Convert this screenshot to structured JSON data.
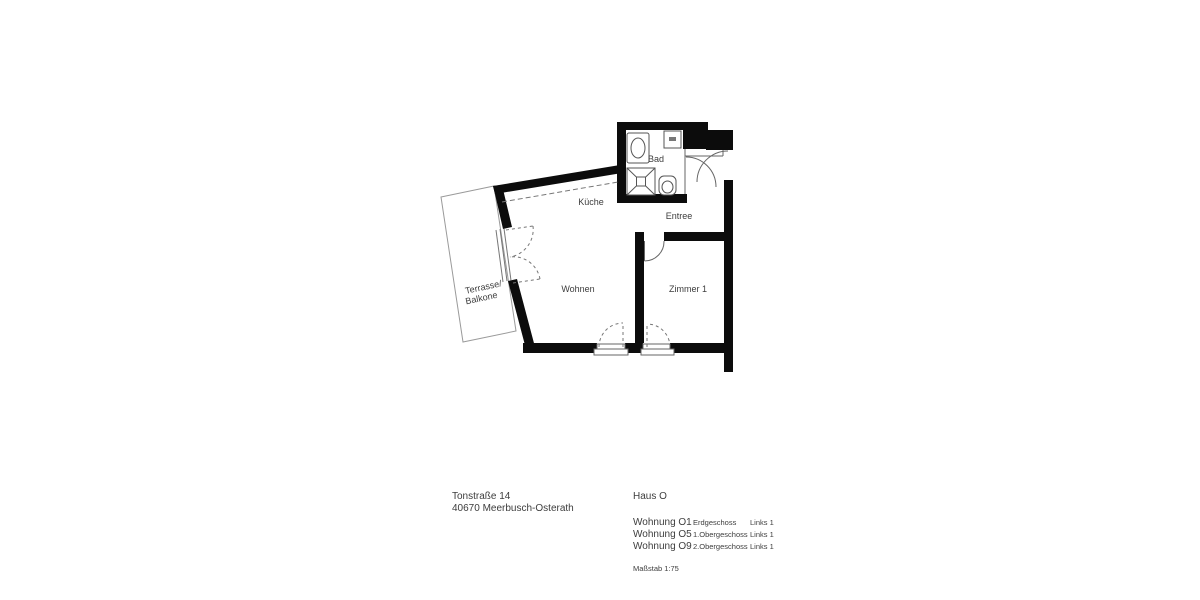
{
  "colors": {
    "wall": "#0c0c0c",
    "text": "#3d3d3d",
    "thin_line": "#666666",
    "light_line": "#9a9a9a"
  },
  "plan": {
    "rooms": {
      "bad": "Bad",
      "kueche": "Küche",
      "entree": "Entree",
      "wohnen": "Wohnen",
      "zimmer1": "Zimmer 1"
    },
    "terrace": {
      "line1": "Terrasse/",
      "line2": "Balkone"
    }
  },
  "footer": {
    "address": {
      "line1": "Tonstraße 14",
      "line2": "40670 Meerbusch-Osterath"
    },
    "building": "Haus O",
    "apartments": [
      {
        "name": "Wohnung O1",
        "floor": "Erdgeschoss",
        "position": "Links 1"
      },
      {
        "name": "Wohnung O5",
        "floor": "1.Obergeschoss",
        "position": "Links 1"
      },
      {
        "name": "Wohnung O9",
        "floor": "2.Obergeschoss",
        "position": "Links 1"
      }
    ],
    "scale": "Maßstab 1:75"
  }
}
